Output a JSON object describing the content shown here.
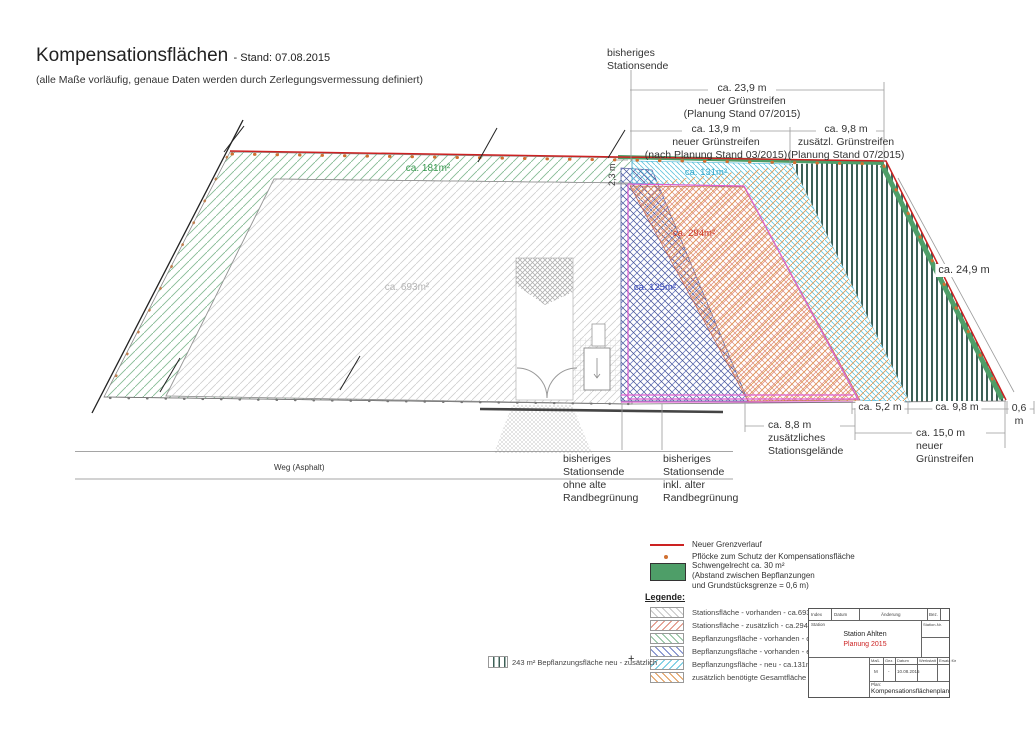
{
  "header": {
    "title": "Kompensationsflächen",
    "stand": "- Stand: 07.08.2015",
    "subtitle": "(alle Maße vorläufig, genaue Daten werden durch Zerlegungsvermessung definiert)"
  },
  "annotations": {
    "station_end_top": "bisheriges\nStationsende",
    "dim_23_9": "ca. 23,9 m\nneuer Grünstreifen\n(Planung Stand 07/2015)",
    "dim_13_9": "ca. 13,9 m\nneuer Grünstreifen\n(nach Planung Stand 03/2015)",
    "dim_9_8_top": "ca. 9,8 m\nzusätzl. Grünstreifen\n(Planung Stand 07/2015)",
    "dim_24_9": "ca. 24,9 m",
    "dim_2_3": "2,3 m",
    "dim_5_2": "ca. 5,2 m",
    "dim_9_8_bottom": "ca. 9,8 m",
    "dim_0_6": "0,6 m",
    "dim_8_8": "ca. 8,8 m\nzusätzliches\nStationsgelände",
    "dim_15_0": "ca. 15,0 m\nneuer\nGrünstreifen",
    "station_end_left": "bisheriges\nStationsende\nohne alte\nRandbegrünung",
    "station_end_right": "bisheriges\nStationsende\ninkl. alter\nRandbegrünung",
    "weg": "Weg (Asphalt)"
  },
  "areas": {
    "a693": "ca. 693m²",
    "a181": "ca. 181m²",
    "a131": "ca. 131m²",
    "a294": "ca. 294m²",
    "a125": "ca. 125m²"
  },
  "legend": {
    "heading": "Legende:",
    "grenzverlauf": "Neuer Grenzverlauf",
    "pfloecke": "Pflöcke zum Schutz der Kompensationsfläche",
    "schwengelrecht": "Schwengelrecht ca. 30 m²\n(Abstand zwischen Bepflanzungen\nund Grundstücksgrenze = 0,6 m)",
    "items": [
      {
        "label": "Stationsfläche - vorhanden - ca.693m²"
      },
      {
        "label": "Stationsfläche - zusätzlich - ca.294m²"
      },
      {
        "label": "Bepflanzungsfläche - vorhanden - ca.181m²"
      },
      {
        "label": "Bepflanzungsfläche - vorhanden - entfernen - ca.125m²"
      },
      {
        "label": "Bepflanzungsfläche - neu - ca.131m²"
      },
      {
        "label": "zusätzlich benötigte Gesamtfläche - ca.316m²"
      }
    ],
    "side_note": "243 m² Bepflanzungsfläche neu - zusätzlich",
    "plus": "+"
  },
  "title_block": {
    "header": [
      "Index",
      "Datum",
      "Änderung",
      "Bez."
    ],
    "station_label": "Station",
    "station_nr_label": "Station-Nr.",
    "station_name": "Station Ahlten",
    "planning": "Planung 2015",
    "row_headers": [
      "Maß.",
      "Gez.",
      "Datum",
      "Werkstatt",
      "Ersatz für"
    ],
    "row_values": [
      "M",
      "-",
      "10.08.2015"
    ],
    "plan_label": "Plan:",
    "plan_name": "Kompensationsflächenplan"
  },
  "colors": {
    "boundary_red": "#cc2222",
    "schwengelrecht_green": "#4e9e68",
    "peg_orange": "#d07030",
    "hatch_gray": "#cfcfcf",
    "hatch_green": "#85bb95",
    "hatch_blue": "#6f7fc6",
    "hatch_red": "#dd8877",
    "hatch_cyan": "#62c4de",
    "hatch_orange": "#e09a55",
    "outline_magenta": "#e060d0",
    "stripes_dark": "#3d6057",
    "planning_red": "#cc2222"
  }
}
